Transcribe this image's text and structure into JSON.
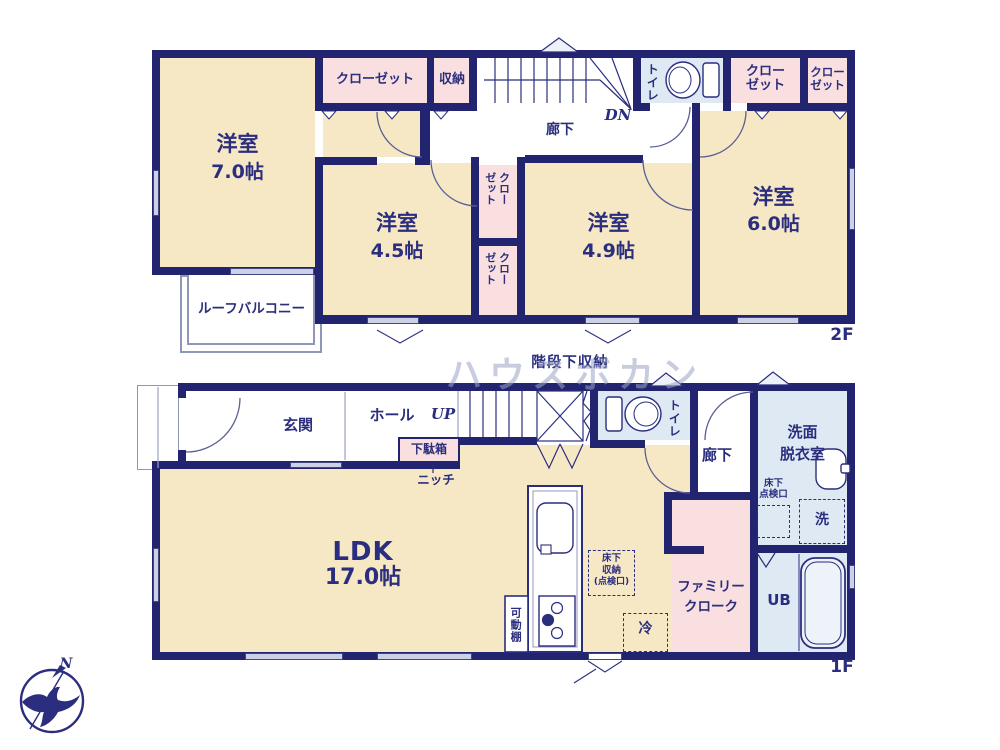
{
  "watermark": "ハウスボカン",
  "compass": {
    "n": "N"
  },
  "f2": {
    "label": "2F",
    "room_7": {
      "name": "洋室",
      "size": "7.0帖"
    },
    "room_45": {
      "name": "洋室",
      "size": "4.5帖"
    },
    "room_49": {
      "name": "洋室",
      "size": "4.9帖"
    },
    "room_6": {
      "name": "洋室",
      "size": "6.0帖"
    },
    "closet_top": "クローゼット",
    "storage": "収納",
    "toilet": "トイレ",
    "hallway": "廊下",
    "dn": "DN",
    "closet_right_a": {
      "l1": "クロー",
      "l2": "ゼット"
    },
    "closet_right_b": {
      "l1": "クロー",
      "l2": "ゼット"
    },
    "closet_mid_a": {
      "l1": "クロー",
      "l2": "ゼット"
    },
    "closet_mid_b": {
      "l1": "クロー",
      "l2": "ゼット"
    },
    "roof_balcony": "ルーフバルコニー"
  },
  "f1": {
    "label": "1F",
    "genkan": "玄関",
    "hall": "ホール",
    "up": "UP",
    "stair_storage": "階段下収納",
    "getabako": "下駄箱",
    "niche": "ニッチ",
    "ldk": {
      "name": "LDK",
      "size": "17.0帖"
    },
    "toilet": "トイレ",
    "hallway": "廊下",
    "washroom": {
      "l1": "洗面",
      "l2": "脱衣室"
    },
    "floor_hatch": {
      "l1": "床下",
      "l2": "点検口"
    },
    "washer": "洗",
    "ub": "UB",
    "family_cloak": {
      "l1": "ファミリー",
      "l2": "クローク"
    },
    "fridge": "冷",
    "kitchen_hatch": {
      "l1": "床下",
      "l2": "収納",
      "l3": "(点検口)"
    },
    "movable_shelf": "可動棚"
  }
}
